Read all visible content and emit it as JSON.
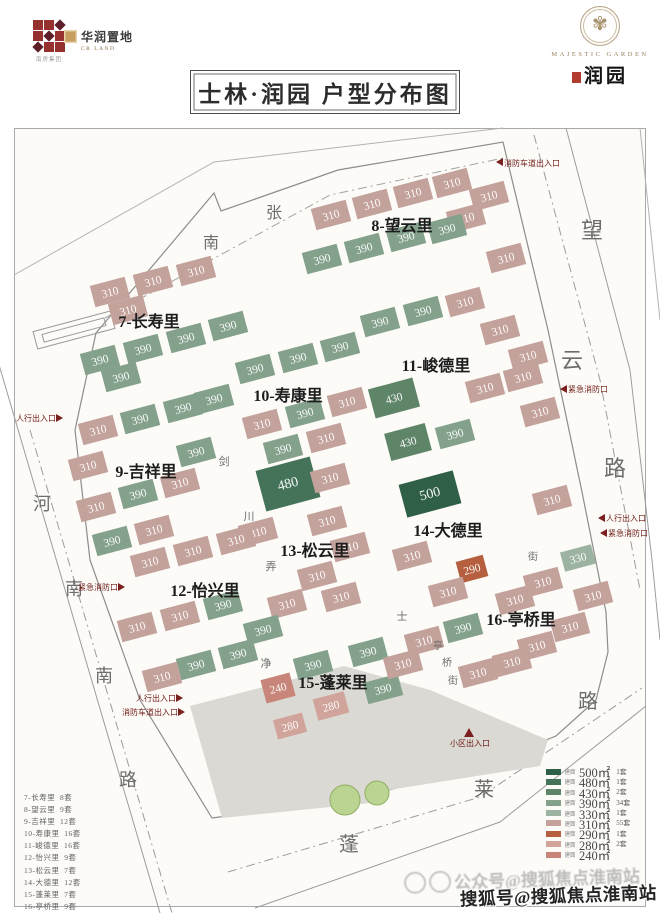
{
  "header": {
    "group_caption": "南房集团",
    "crland_name": "华润置地",
    "crland_sub": "CR LAND",
    "title": "士林·润园 户型分布图",
    "majestic_en": "MAJESTIC GARDEN",
    "majestic_cn": "润园"
  },
  "watermark": {
    "faint": "公众号@搜狐焦点淮南站",
    "bold": "搜狐号@搜狐焦点淮南站"
  },
  "unit_list": [
    {
      "name": "7-长寿里",
      "count": "8套"
    },
    {
      "name": "8-望云里",
      "count": "9套"
    },
    {
      "name": "9-吉祥里",
      "count": "12套"
    },
    {
      "name": "10-寿康里",
      "count": "16套"
    },
    {
      "name": "11-峻德里",
      "count": "16套"
    },
    {
      "name": "12-怡兴里",
      "count": "9套"
    },
    {
      "name": "13-松云里",
      "count": "7套"
    },
    {
      "name": "14-大德里",
      "count": "12套"
    },
    {
      "name": "15-蓬莱里",
      "count": "7套"
    },
    {
      "name": "16-亭桥里",
      "count": "9套"
    }
  ],
  "legend": [
    {
      "key": "500",
      "prefix": "建面",
      "area": "500㎡",
      "count": "1套"
    },
    {
      "key": "480",
      "prefix": "建面",
      "area": "480㎡",
      "count": "1套"
    },
    {
      "key": "430",
      "prefix": "建面",
      "area": "430㎡",
      "count": "2套"
    },
    {
      "key": "390",
      "prefix": "建面",
      "area": "390㎡",
      "count": "34套"
    },
    {
      "key": "330",
      "prefix": "建面",
      "area": "330㎡",
      "count": "1套"
    },
    {
      "key": "310",
      "prefix": "建面",
      "area": "310㎡",
      "count": "55套"
    },
    {
      "key": "290",
      "prefix": "建面",
      "area": "290㎡",
      "count": "1套"
    },
    {
      "key": "280",
      "prefix": "建面",
      "area": "280㎡",
      "count": "2套"
    },
    {
      "key": "240",
      "prefix": "建面",
      "area": "240㎡",
      "count": ""
    }
  ],
  "map": {
    "area_colors": {
      "500": "#2f5f47",
      "480": "#44735a",
      "430": "#5f8569",
      "390": "#84a18c",
      "330": "#9cb3a1",
      "310": "#c4a29c",
      "290": "#b55f3e",
      "280": "#d0a49b",
      "240": "#c8857a"
    },
    "lines": [
      {
        "n": "site-wall",
        "d": "M96,333 L214,193 L221,211 L338,170 L503,142 L548,330 L582,492 L606,612 L608,652 L596,700 L556,736 L470,770 L348,800 L212,818 L140,700 L90,560 L75,430 Z",
        "c": "#8c8c8c",
        "w": 1.2
      },
      {
        "n": "north-outer-line",
        "d": "M14,275 L214,162 L503,128",
        "c": "#b2b2b2"
      },
      {
        "n": "north-road-centerline",
        "d": "M105,318 L330,195 L503,158",
        "c": "#a3a3a3",
        "dash": "9,4,2,4"
      },
      {
        "n": "west-road-outer",
        "d": "M-20,300 L160,913",
        "c": "#9c9c9c"
      },
      {
        "n": "west-road-centerline",
        "d": "M30,430 L172,913",
        "c": "#9c9c9c",
        "dash": "9,4,2,4"
      },
      {
        "n": "east-road-outer",
        "d": "M566,128 L630,370 L652,560 L660,640",
        "c": "#9c9c9c"
      },
      {
        "n": "east-road-outer2",
        "d": "M640,128 L660,320",
        "c": "#b2b2b2"
      },
      {
        "n": "east-road-centerline",
        "d": "M534,135 L600,380 L640,590",
        "c": "#9c9c9c",
        "dash": "9,4,2,4"
      },
      {
        "n": "south-road-outer",
        "d": "M255,908 L500,822 L646,706",
        "c": "#9c9c9c"
      },
      {
        "n": "south-road-centerline",
        "d": "M228,872 L480,797 L642,688",
        "c": "#9c9c9c",
        "dash": "9,4,2,4"
      }
    ],
    "gray_areas": [
      "190,706 344,666 380,802 222,818",
      "344,666 430,690 548,740 540,766 376,792"
    ],
    "outline_blocks": [
      {
        "x": 74,
        "y": 330,
        "w": 80,
        "h": 18
      },
      {
        "x": 74,
        "y": 330,
        "w": 64,
        "h": 8
      }
    ],
    "buildings": [
      [
        110,
        292,
        "310"
      ],
      [
        153,
        281,
        "310"
      ],
      [
        196,
        271,
        "310"
      ],
      [
        128,
        310,
        "310"
      ],
      [
        100,
        360,
        "390"
      ],
      [
        143,
        349,
        "390"
      ],
      [
        186,
        338,
        "390"
      ],
      [
        228,
        326,
        "390"
      ],
      [
        121,
        377,
        "390"
      ],
      [
        331,
        215,
        "310"
      ],
      [
        372,
        204,
        "310"
      ],
      [
        413,
        193,
        "310"
      ],
      [
        452,
        183,
        "310"
      ],
      [
        489,
        196,
        "310"
      ],
      [
        466,
        218,
        "310"
      ],
      [
        506,
        258,
        "310"
      ],
      [
        322,
        259,
        "390"
      ],
      [
        364,
        248,
        "390"
      ],
      [
        406,
        237,
        "390"
      ],
      [
        447,
        229,
        "390"
      ],
      [
        98,
        430,
        "310"
      ],
      [
        140,
        419,
        "390"
      ],
      [
        183,
        408,
        "390"
      ],
      [
        88,
        466,
        "310"
      ],
      [
        196,
        452,
        "390"
      ],
      [
        96,
        507,
        "310"
      ],
      [
        138,
        494,
        "390"
      ],
      [
        180,
        483,
        "310"
      ],
      [
        112,
        541,
        "390"
      ],
      [
        154,
        530,
        "310"
      ],
      [
        255,
        369,
        "390"
      ],
      [
        298,
        358,
        "390"
      ],
      [
        340,
        347,
        "390"
      ],
      [
        262,
        424,
        "310"
      ],
      [
        305,
        413,
        "390"
      ],
      [
        347,
        402,
        "310"
      ],
      [
        283,
        449,
        "390"
      ],
      [
        326,
        438,
        "310"
      ],
      [
        214,
        399,
        "390"
      ],
      [
        380,
        322,
        "390"
      ],
      [
        423,
        311,
        "390"
      ],
      [
        465,
        302,
        "310"
      ],
      [
        394,
        398,
        "430",
        46,
        30
      ],
      [
        408,
        442,
        "430",
        42,
        28
      ],
      [
        455,
        434,
        "390"
      ],
      [
        485,
        388,
        "310"
      ],
      [
        523,
        377,
        "310"
      ],
      [
        540,
        412,
        "310"
      ],
      [
        528,
        356,
        "310"
      ],
      [
        500,
        330,
        "310"
      ],
      [
        288,
        484,
        "480",
        56,
        42
      ],
      [
        330,
        478,
        "310"
      ],
      [
        327,
        521,
        "310"
      ],
      [
        350,
        547,
        "310"
      ],
      [
        317,
        576,
        "310"
      ],
      [
        287,
        604,
        "310"
      ],
      [
        341,
        597,
        "310"
      ],
      [
        258,
        532,
        "310"
      ],
      [
        150,
        562,
        "310"
      ],
      [
        193,
        551,
        "310"
      ],
      [
        236,
        540,
        "310"
      ],
      [
        137,
        627,
        "310"
      ],
      [
        180,
        616,
        "310"
      ],
      [
        223,
        605,
        "390"
      ],
      [
        196,
        665,
        "390"
      ],
      [
        238,
        654,
        "390"
      ],
      [
        162,
        677,
        "310"
      ],
      [
        263,
        630,
        "390"
      ],
      [
        430,
        494,
        "500",
        56,
        34
      ],
      [
        472,
        569,
        "290",
        28,
        22
      ],
      [
        412,
        556,
        "310"
      ],
      [
        448,
        592,
        "310"
      ],
      [
        552,
        500,
        "310"
      ],
      [
        578,
        558,
        "330",
        32,
        20
      ],
      [
        543,
        582,
        "310"
      ],
      [
        593,
        596,
        "310"
      ],
      [
        515,
        600,
        "310"
      ],
      [
        463,
        628,
        "390"
      ],
      [
        570,
        627,
        "310"
      ],
      [
        537,
        646,
        "310"
      ],
      [
        478,
        673,
        "310"
      ],
      [
        512,
        662,
        "310"
      ],
      [
        278,
        688,
        "240",
        30,
        24
      ],
      [
        313,
        665,
        "390"
      ],
      [
        368,
        652,
        "390"
      ],
      [
        331,
        706,
        "280",
        32,
        22
      ],
      [
        290,
        726,
        "280",
        30,
        20
      ],
      [
        383,
        689,
        "390"
      ],
      [
        424,
        641,
        "310"
      ],
      [
        403,
        664,
        "310"
      ]
    ],
    "trees": [
      [
        345,
        800,
        15
      ],
      [
        377,
        793,
        12
      ]
    ],
    "district_labels": [
      {
        "t": "7-长寿里",
        "x": 149,
        "y": 327
      },
      {
        "t": "8-望云里",
        "x": 402,
        "y": 231
      },
      {
        "t": "9-吉祥里",
        "x": 146,
        "y": 477
      },
      {
        "t": "10-寿康里",
        "x": 288,
        "y": 401
      },
      {
        "t": "11-峻德里",
        "x": 436,
        "y": 371
      },
      {
        "t": "12-怡兴里",
        "x": 205,
        "y": 596
      },
      {
        "t": "13-松云里",
        "x": 315,
        "y": 556
      },
      {
        "t": "14-大德里",
        "x": 448,
        "y": 536
      },
      {
        "t": "15-蓬莱里",
        "x": 333,
        "y": 688
      },
      {
        "t": "16-亭桥里",
        "x": 521,
        "y": 625
      }
    ],
    "street_labels": [
      {
        "t": "南",
        "x": 211,
        "y": 248,
        "s": 16
      },
      {
        "t": "张",
        "x": 274,
        "y": 218,
        "s": 16
      },
      {
        "t": "望",
        "x": 592,
        "y": 238,
        "s": 22
      },
      {
        "t": "云",
        "x": 572,
        "y": 368,
        "s": 22
      },
      {
        "t": "路",
        "x": 615,
        "y": 476,
        "s": 22
      },
      {
        "t": "河",
        "x": 42,
        "y": 510,
        "s": 18
      },
      {
        "t": "南",
        "x": 74,
        "y": 595,
        "s": 18
      },
      {
        "t": "南",
        "x": 104,
        "y": 682,
        "s": 18
      },
      {
        "t": "路",
        "x": 128,
        "y": 786,
        "s": 18
      },
      {
        "t": "蓬",
        "x": 349,
        "y": 851,
        "s": 20
      },
      {
        "t": "莱",
        "x": 484,
        "y": 796,
        "s": 20
      },
      {
        "t": "路",
        "x": 588,
        "y": 708,
        "s": 20
      },
      {
        "t": "剑",
        "x": 224,
        "y": 465,
        "s": 11
      },
      {
        "t": "川",
        "x": 249,
        "y": 520,
        "s": 11
      },
      {
        "t": "弄",
        "x": 271,
        "y": 570,
        "s": 11
      },
      {
        "t": "士",
        "x": 402,
        "y": 620,
        "s": 11
      },
      {
        "t": "净",
        "x": 266,
        "y": 667,
        "s": 11
      },
      {
        "t": "亭",
        "x": 438,
        "y": 649,
        "s": 10
      },
      {
        "t": "桥",
        "x": 447,
        "y": 666,
        "s": 10
      },
      {
        "t": "街",
        "x": 453,
        "y": 684,
        "s": 10
      },
      {
        "t": "街",
        "x": 533,
        "y": 560,
        "s": 10
      }
    ],
    "entrances": [
      {
        "t": "消防车道出入口",
        "x": 504,
        "y": 166,
        "a": "start",
        "tx": 496,
        "ty": 162,
        "dir": "l"
      },
      {
        "t": "紧急消防口",
        "x": 568,
        "y": 392,
        "a": "start",
        "tx": 560,
        "ty": 389,
        "dir": "l"
      },
      {
        "t": "人行出入口",
        "x": 606,
        "y": 521,
        "a": "start",
        "tx": 598,
        "ty": 518,
        "dir": "l"
      },
      {
        "t": "紧急消防口",
        "x": 608,
        "y": 536,
        "a": "start",
        "tx": 600,
        "ty": 533,
        "dir": "l"
      },
      {
        "t": "人行出入口",
        "x": 56,
        "y": 421,
        "a": "end",
        "tx": 63,
        "ty": 418,
        "dir": "r"
      },
      {
        "t": "紧急消防口",
        "x": 118,
        "y": 590,
        "a": "end",
        "tx": 125,
        "ty": 587,
        "dir": "r"
      },
      {
        "t": "人行出入口",
        "x": 176,
        "y": 701,
        "a": "end",
        "tx": 183,
        "ty": 698,
        "dir": "r"
      },
      {
        "t": "消防车道出入口",
        "x": 178,
        "y": 715,
        "a": "end",
        "tx": 185,
        "ty": 712,
        "dir": "r"
      },
      {
        "t": "小区出入口",
        "x": 470,
        "y": 746,
        "a": "middle",
        "tx": 469,
        "ty": 728,
        "dir": "u"
      }
    ]
  }
}
